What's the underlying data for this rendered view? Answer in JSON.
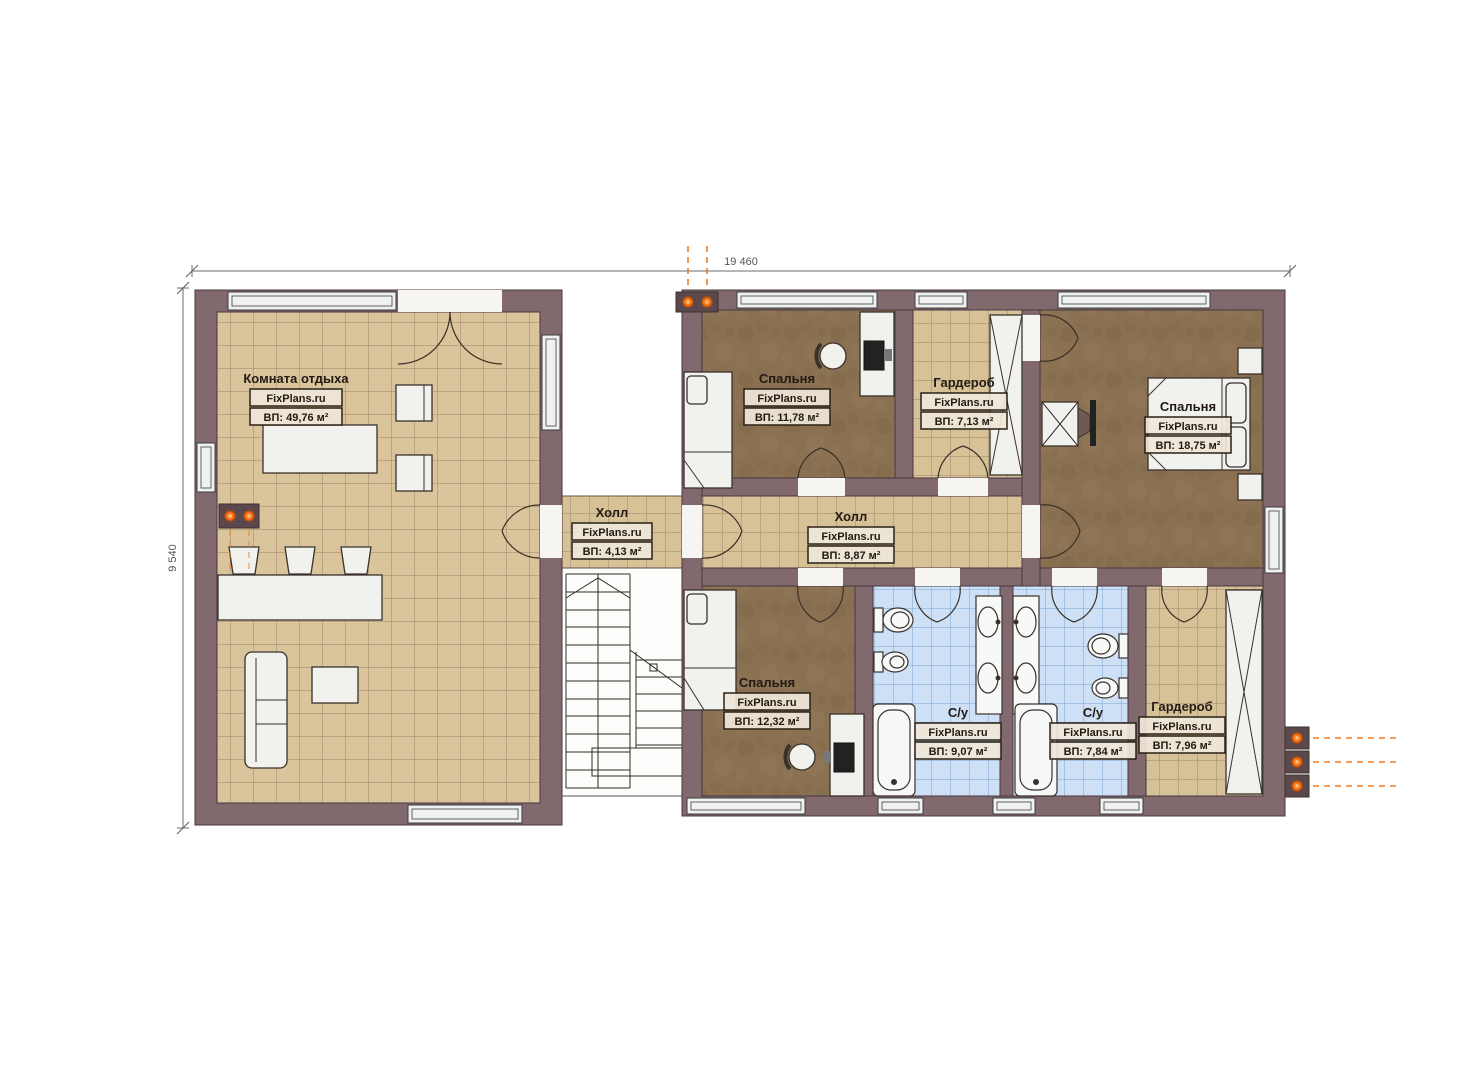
{
  "dimensions": {
    "width_label": "19 460",
    "height_label": "9 540"
  },
  "brand": "FixPlans.ru",
  "rooms": [
    {
      "name": "Комната отдыха",
      "brand": "FixPlans.ru",
      "area": "ВП: 49,76 м²"
    },
    {
      "name": "Спальня",
      "brand": "FixPlans.ru",
      "area": "ВП: 11,78 м²"
    },
    {
      "name": "Гардероб",
      "brand": "FixPlans.ru",
      "area": "ВП: 7,13 м²"
    },
    {
      "name": "Спальня",
      "brand": "FixPlans.ru",
      "area": "ВП: 18,75 м²"
    },
    {
      "name": "Холл",
      "brand": "FixPlans.ru",
      "area": "ВП: 4,13 м²"
    },
    {
      "name": "Холл",
      "brand": "FixPlans.ru",
      "area": "ВП: 8,87 м²"
    },
    {
      "name": "Спальня",
      "brand": "FixPlans.ru",
      "area": "ВП: 12,32 м²"
    },
    {
      "name": "С/у",
      "brand": "FixPlans.ru",
      "area": "ВП: 9,07 м²"
    },
    {
      "name": "С/у",
      "brand": "FixPlans.ru",
      "area": "ВП: 7,84 м²"
    },
    {
      "name": "Гардероб",
      "brand": "FixPlans.ru",
      "area": "ВП: 7,96 м²"
    }
  ],
  "colors": {
    "wall": "#82696d",
    "floor_tile": "#d9c49b",
    "floor_carpet": "#8a7152",
    "floor_bath": "#cde0f5",
    "accent_orange": "#ef7b25"
  }
}
